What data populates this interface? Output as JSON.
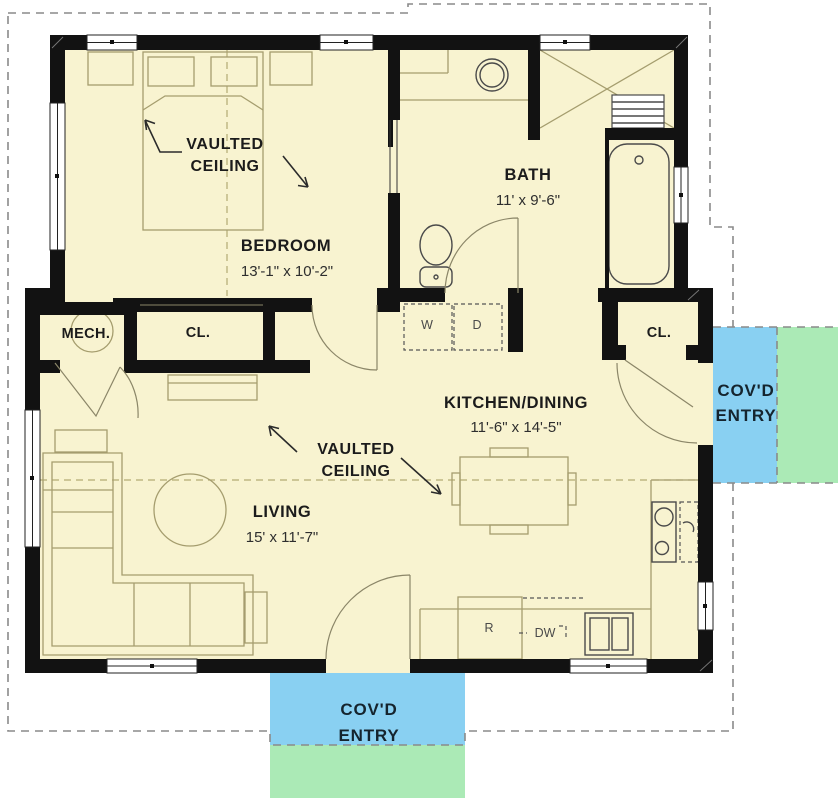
{
  "colors": {
    "floor": "#f8f3d0",
    "wall": "#121212",
    "entry_blue": "#89d0f2",
    "entry_green": "#abeab6",
    "roof_dash": "#8a8a8a"
  },
  "rooms": {
    "bedroom": {
      "name": "BEDROOM",
      "dims": "13'-1\" x 10'-2\""
    },
    "bath": {
      "name": "BATH",
      "dims": "11' x 9'-6\""
    },
    "kitchen_dining": {
      "name": "KITCHEN/DINING",
      "dims": "11'-6\" x 14'-5\""
    },
    "living": {
      "name": "LIVING",
      "dims": "15' x 11'-7\""
    },
    "mech": {
      "name": "MECH."
    },
    "bedroom_closet": {
      "name": "CL."
    },
    "entry_closet": {
      "name": "CL."
    }
  },
  "annotations": {
    "vaulted_bedroom": {
      "line1": "VAULTED",
      "line2": "CEILING"
    },
    "vaulted_living": {
      "line1": "VAULTED",
      "line2": "CEILING"
    }
  },
  "appliances": {
    "washer": "W",
    "dryer": "D",
    "refrigerator": "R",
    "dishwasher": "DW"
  },
  "entries": {
    "right": {
      "line1": "COV'D",
      "line2": "ENTRY"
    },
    "bottom": {
      "line1": "COV'D",
      "line2": "ENTRY"
    }
  }
}
